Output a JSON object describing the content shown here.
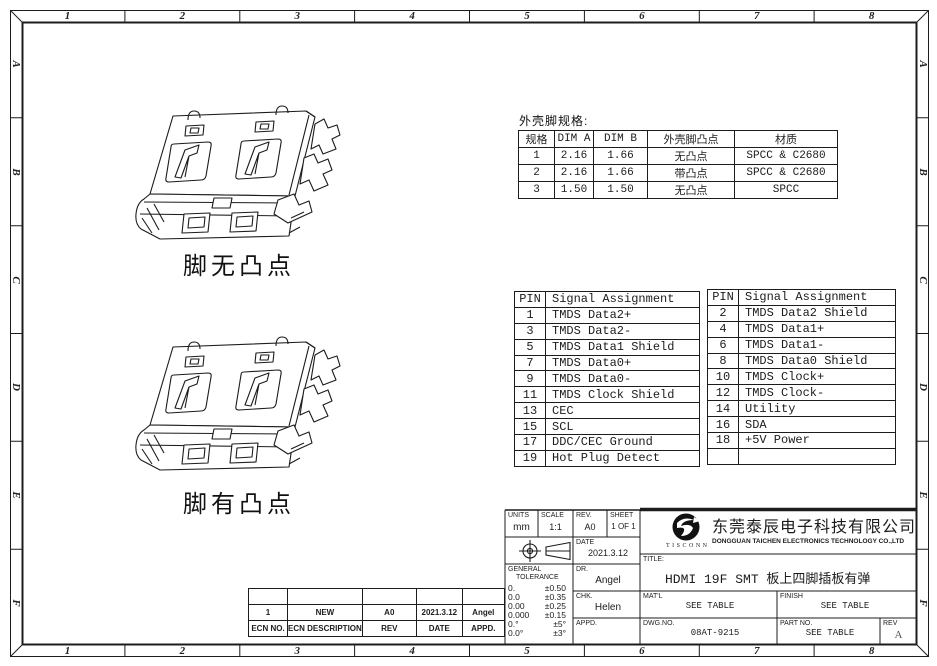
{
  "page": {
    "background": "#ffffff",
    "line_color": "#1c1c1c"
  },
  "zones": {
    "columns": [
      "1",
      "2",
      "3",
      "4",
      "5",
      "6",
      "7",
      "8"
    ],
    "rows": [
      "A",
      "B",
      "C",
      "D",
      "E",
      "F"
    ]
  },
  "views": [
    {
      "label": "脚无凸点"
    },
    {
      "label": "脚有凸点"
    }
  ],
  "shell_spec_table": {
    "title": "外壳脚规格:",
    "headers": [
      "规格",
      "DIM A",
      "DIM B",
      "外壳脚凸点",
      "材质"
    ],
    "rows": [
      [
        "1",
        "2.16",
        "1.66",
        "无凸点",
        "SPCC & C2680"
      ],
      [
        "2",
        "2.16",
        "1.66",
        "带凸点",
        "SPCC & C2680"
      ],
      [
        "3",
        "1.50",
        "1.50",
        "无凸点",
        "SPCC"
      ]
    ]
  },
  "pin_table_left": {
    "headers": [
      "PIN",
      "Signal Assignment"
    ],
    "rows": [
      [
        "1",
        "TMDS Data2+"
      ],
      [
        "3",
        "TMDS Data2-"
      ],
      [
        "5",
        "TMDS Data1 Shield"
      ],
      [
        "7",
        "TMDS Data0+"
      ],
      [
        "9",
        "TMDS Data0-"
      ],
      [
        "11",
        "TMDS Clock Shield"
      ],
      [
        "13",
        "CEC"
      ],
      [
        "15",
        "SCL"
      ],
      [
        "17",
        "DDC/CEC Ground"
      ],
      [
        "19",
        "Hot Plug Detect"
      ]
    ]
  },
  "pin_table_right": {
    "headers": [
      "PIN",
      "Signal Assignment"
    ],
    "rows": [
      [
        "2",
        "TMDS Data2 Shield"
      ],
      [
        "4",
        "TMDS Data1+"
      ],
      [
        "6",
        "TMDS Data1-"
      ],
      [
        "8",
        "TMDS Data0 Shield"
      ],
      [
        "10",
        "TMDS Clock+"
      ],
      [
        "12",
        "TMDS Clock-"
      ],
      [
        "14",
        "Utility"
      ],
      [
        "16",
        "SDA"
      ],
      [
        "18",
        "+5V Power"
      ],
      [
        "",
        ""
      ]
    ]
  },
  "title_block": {
    "units_label": "UNITS",
    "units_value": "mm",
    "scale_label": "SCALE",
    "scale_value": "1:1",
    "rev_label": "REV.",
    "rev_value": "A0",
    "sheet_label": "SHEET",
    "sheet_value": "1 OF 1",
    "date_label": "DATE",
    "date_value": "2021.3.12",
    "tolerance_label_line1": "GENERAL",
    "tolerance_label_line2": "TOLERANCE",
    "tolerances": [
      [
        "0.",
        "±0.50"
      ],
      [
        "0.0",
        "±0.35"
      ],
      [
        "0.00",
        "±0.25"
      ],
      [
        "0.000",
        "±0.15"
      ],
      [
        "0.°",
        "±5°"
      ],
      [
        "0.0°",
        "±3°"
      ]
    ],
    "dr_label": "DR.",
    "dr_value": "Angel",
    "chk_label": "CHK.",
    "chk_value": "Helen",
    "appd_label": "APPD.",
    "appd_value": "",
    "company_cn": "东莞泰辰电子科技有限公司",
    "company_en": "DONGGUAN TAICHEN ELECTRONICS TECHNOLOGY CO.,LTD",
    "logo_text": "TISCONN",
    "logo_monogram": "S",
    "title_label": "TITLE:",
    "title_value": "HDMI 19F SMT 板上四脚插板有弹",
    "matl_label": "MAT'L",
    "matl_value": "SEE TABLE",
    "finish_label": "FINISH",
    "finish_value": "SEE TABLE",
    "dwgno_label": "DWG.NO.",
    "dwgno_value": "08AT-9215",
    "partno_label": "PART NO.",
    "partno_value": "SEE TABLE",
    "rev2_label": "REV",
    "rev2_value": "A"
  },
  "ecn_table": {
    "headers": [
      "ECN NO.",
      "ECN DESCRIPTION",
      "REV",
      "DATE",
      "APPD."
    ],
    "rows": [
      [
        "",
        "",
        "",
        "",
        ""
      ],
      [
        "1",
        "NEW",
        "A0",
        "2021.3.12",
        "Angel"
      ]
    ]
  }
}
